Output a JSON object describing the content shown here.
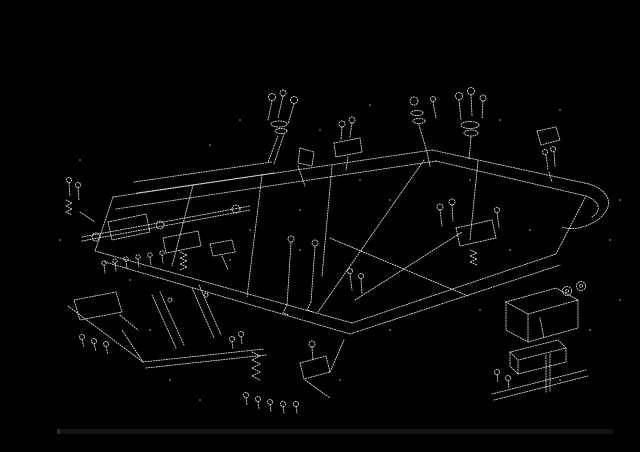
{
  "canvas": {
    "width": 640,
    "height": 452,
    "background": "#000000"
  },
  "diagram": {
    "description": "exploded-parts-diagram",
    "stroke_color": "#ededed",
    "stroke_width": 0.9,
    "stroke_dash": "1.2 1.4",
    "stroke_opacity": 0.92,
    "dot_color": "#d8d8d8",
    "elements": [
      {
        "t": "p",
        "d": "M113,197 L432,150"
      },
      {
        "t": "p",
        "d": "M116,209 L436,161"
      },
      {
        "t": "p",
        "d": "M134,182 L272,162"
      },
      {
        "t": "p",
        "d": "M137,193 L274,173"
      },
      {
        "t": "p",
        "d": "M432,150 L589,184"
      },
      {
        "t": "p",
        "d": "M436,161 L586,196"
      },
      {
        "t": "p",
        "d": "M589,184 C611,191 614,206 600,218 C589,227 573,231 562,227"
      },
      {
        "t": "p",
        "d": "M586,196 C600,201 602,211 592,217"
      },
      {
        "t": "p",
        "d": "M113,197 L95,251"
      },
      {
        "t": "p",
        "d": "M95,251 L352,323"
      },
      {
        "t": "p",
        "d": "M105,262 L350,334"
      },
      {
        "t": "p",
        "d": "M352,323 L556,254"
      },
      {
        "t": "p",
        "d": "M350,334 L560,265"
      },
      {
        "t": "p",
        "d": "M556,254 L586,196"
      },
      {
        "t": "p",
        "d": "M193,185 L172,266"
      },
      {
        "t": "p",
        "d": "M262,175 L247,297"
      },
      {
        "t": "p",
        "d": "M332,166 L322,276"
      },
      {
        "t": "p",
        "d": "M478,161 L470,240"
      },
      {
        "t": "p",
        "d": "M330,238 L468,296"
      },
      {
        "t": "p",
        "d": "M355,300 L462,232"
      },
      {
        "t": "p",
        "d": "M424,160 L318,312"
      },
      {
        "t": "p",
        "d": "M143,362 L264,349"
      },
      {
        "t": "p",
        "d": "M146,368 L266,355"
      },
      {
        "t": "p",
        "d": "M143,362 L122,330"
      },
      {
        "t": "p",
        "d": "M68,306 L143,362"
      },
      {
        "t": "c",
        "cx": 272,
        "cy": 97,
        "r": 3.5
      },
      {
        "t": "c",
        "cx": 283,
        "cy": 93,
        "r": 3
      },
      {
        "t": "c",
        "cx": 294,
        "cy": 100,
        "r": 3.5
      },
      {
        "t": "p",
        "d": "M272,101 L268,120 M283,96 L278,118 M294,104 L288,124"
      },
      {
        "t": "e",
        "cx": 279,
        "cy": 124,
        "rx": 8,
        "ry": 3
      },
      {
        "t": "e",
        "cx": 281,
        "cy": 131,
        "rx": 6,
        "ry": 2.5
      },
      {
        "t": "p",
        "d": "M278,136 L268,162 M284,134 L274,164"
      },
      {
        "t": "p",
        "d": "M300,148 L314,152 L312,166 L298,163 Z"
      },
      {
        "t": "p",
        "d": "M298,166 L305,186"
      },
      {
        "t": "c",
        "cx": 342,
        "cy": 124,
        "r": 3
      },
      {
        "t": "c",
        "cx": 352,
        "cy": 120,
        "r": 3
      },
      {
        "t": "p",
        "d": "M342,127 L341,140 M352,123 L350,137"
      },
      {
        "t": "p",
        "d": "M334,143 L360,138 L362,152 L336,157 Z"
      },
      {
        "t": "p",
        "d": "M348,157 L346,170"
      },
      {
        "t": "c",
        "cx": 414,
        "cy": 101,
        "r": 4
      },
      {
        "t": "e",
        "cx": 417,
        "cy": 113,
        "rx": 6,
        "ry": 2.5
      },
      {
        "t": "e",
        "cx": 419,
        "cy": 121,
        "rx": 6,
        "ry": 2.5
      },
      {
        "t": "p",
        "d": "M419,125 L427,152 L430,166"
      },
      {
        "t": "c",
        "cx": 433,
        "cy": 99,
        "r": 2.5
      },
      {
        "t": "p",
        "d": "M433,102 L436,118"
      },
      {
        "t": "c",
        "cx": 459,
        "cy": 96,
        "r": 3.5
      },
      {
        "t": "c",
        "cx": 471,
        "cy": 91,
        "r": 3.5
      },
      {
        "t": "c",
        "cx": 483,
        "cy": 98,
        "r": 3
      },
      {
        "t": "p",
        "d": "M459,100 L461,120 M471,95 L472,116 M483,101 L482,119"
      },
      {
        "t": "e",
        "cx": 470,
        "cy": 125,
        "rx": 9,
        "ry": 3.5
      },
      {
        "t": "e",
        "cx": 471,
        "cy": 133,
        "rx": 7,
        "ry": 3
      },
      {
        "t": "p",
        "d": "M471,137 L469,160"
      },
      {
        "t": "p",
        "d": "M537,131 L556,127 L560,140 L541,145 Z"
      },
      {
        "t": "c",
        "cx": 545,
        "cy": 152,
        "r": 2.5
      },
      {
        "t": "c",
        "cx": 553,
        "cy": 149,
        "r": 2.5
      },
      {
        "t": "p",
        "d": "M546,155 L548,170 M554,152 L555,166 M549,172 L552,182"
      },
      {
        "t": "c",
        "cx": 69,
        "cy": 180,
        "r": 2.5
      },
      {
        "t": "c",
        "cx": 78,
        "cy": 185,
        "r": 2.5
      },
      {
        "t": "p",
        "d": "M69,183 L70,196 M78,188 L79,200"
      },
      {
        "t": "p",
        "d": "M66,200 l6,3 l-6,3 l6,3 l-6,3 l6,3"
      },
      {
        "t": "p",
        "d": "M80,212 L95,222"
      },
      {
        "t": "p",
        "d": "M82,237 L250,206"
      },
      {
        "t": "p",
        "d": "M82,241 L250,210"
      },
      {
        "t": "c",
        "cx": 96,
        "cy": 237,
        "r": 4
      },
      {
        "t": "c",
        "cx": 160,
        "cy": 225,
        "r": 4
      },
      {
        "t": "c",
        "cx": 236,
        "cy": 209,
        "r": 4
      },
      {
        "t": "p",
        "d": "M108,222 L146,214 L150,232 L112,240 Z"
      },
      {
        "t": "p",
        "d": "M163,238 L198,231 L201,246 L166,253 Z"
      },
      {
        "t": "c",
        "cx": 104,
        "cy": 263,
        "r": 2.2
      },
      {
        "t": "c",
        "cx": 115,
        "cy": 261,
        "r": 2.2
      },
      {
        "t": "c",
        "cx": 126,
        "cy": 259,
        "r": 2.2
      },
      {
        "t": "c",
        "cx": 138,
        "cy": 257,
        "r": 2.2
      },
      {
        "t": "c",
        "cx": 150,
        "cy": 255,
        "r": 2.2
      },
      {
        "t": "c",
        "cx": 162,
        "cy": 253,
        "r": 2.2
      },
      {
        "t": "p",
        "d": "M104,265 l1,8 M115,263 l1,8 M126,261 l1,8 M138,259 l1,8 M150,257 l1,8 M162,255 l1,8"
      },
      {
        "t": "p",
        "d": "M180,252 l7,3 l-7,3 l7,3 l-7,3 l7,3 l-7,3"
      },
      {
        "t": "p",
        "d": "M210,244 L232,240 L235,252 L213,256 Z"
      },
      {
        "t": "p",
        "d": "M222,256 L228,270"
      },
      {
        "t": "p",
        "d": "M74,300 L116,292 L122,312 L80,320 Z"
      },
      {
        "t": "c",
        "cx": 82,
        "cy": 337,
        "r": 2.5
      },
      {
        "t": "c",
        "cx": 94,
        "cy": 341,
        "r": 2.5
      },
      {
        "t": "c",
        "cx": 106,
        "cy": 344,
        "r": 2.5
      },
      {
        "t": "p",
        "d": "M82,340 l2,7 M94,344 l2,7 M106,347 l2,7"
      },
      {
        "t": "p",
        "d": "M120,315 L138,330"
      },
      {
        "t": "p",
        "d": "M152,295 L176,348"
      },
      {
        "t": "p",
        "d": "M160,292 L184,345"
      },
      {
        "t": "p",
        "d": "M192,288 L214,338"
      },
      {
        "t": "p",
        "d": "M199,285 L221,335"
      },
      {
        "t": "c",
        "cx": 170,
        "cy": 300,
        "r": 2
      },
      {
        "t": "c",
        "cx": 206,
        "cy": 295,
        "r": 2
      },
      {
        "t": "p",
        "d": "M252,352 l8,4 l-8,4 l8,4 l-8,4 l8,4 l-8,4 l8,4"
      },
      {
        "t": "c",
        "cx": 246,
        "cy": 395,
        "r": 2.5
      },
      {
        "t": "c",
        "cx": 258,
        "cy": 399,
        "r": 2.5
      },
      {
        "t": "c",
        "cx": 270,
        "cy": 402,
        "r": 2.5
      },
      {
        "t": "c",
        "cx": 283,
        "cy": 404,
        "r": 2.5
      },
      {
        "t": "c",
        "cx": 296,
        "cy": 404,
        "r": 2.5
      },
      {
        "t": "p",
        "d": "M246,398 l1,7 M258,402 l1,7 M270,405 l1,6 M283,407 l1,6 M296,407 l1,6"
      },
      {
        "t": "p",
        "d": "M300,363 L326,356 L330,372 L304,379 Z"
      },
      {
        "t": "c",
        "cx": 312,
        "cy": 344,
        "r": 3
      },
      {
        "t": "p",
        "d": "M312,347 L313,360"
      },
      {
        "t": "p",
        "d": "M305,380 L330,398 M330,372 L344,340"
      },
      {
        "t": "c",
        "cx": 232,
        "cy": 339,
        "r": 2.5
      },
      {
        "t": "c",
        "cx": 241,
        "cy": 334,
        "r": 2.5
      },
      {
        "t": "p",
        "d": "M232,342 l1,7 M241,337 l1,7"
      },
      {
        "t": "p",
        "d": "M291,243 L287,305"
      },
      {
        "t": "p",
        "d": "M315,247 L311,302"
      },
      {
        "t": "c",
        "cx": 291,
        "cy": 239,
        "r": 3
      },
      {
        "t": "c",
        "cx": 315,
        "cy": 243,
        "r": 3
      },
      {
        "t": "p",
        "d": "M287,305 l-4,8 l6,2 M311,302 l-4,8 l6,2"
      },
      {
        "t": "c",
        "cx": 350,
        "cy": 271,
        "r": 2.5
      },
      {
        "t": "c",
        "cx": 361,
        "cy": 276,
        "r": 2.5
      },
      {
        "t": "p",
        "d": "M350,274 L352,290 M361,279 L362,294"
      },
      {
        "t": "c",
        "cx": 440,
        "cy": 207,
        "r": 3
      },
      {
        "t": "c",
        "cx": 452,
        "cy": 202,
        "r": 3
      },
      {
        "t": "p",
        "d": "M440,210 L442,226 M452,205 L453,221"
      },
      {
        "t": "p",
        "d": "M456,228 L492,220 L496,238 L460,246 Z"
      },
      {
        "t": "p",
        "d": "M470,250 l7,3 l-7,3 l7,3 l-7,3 l7,3"
      },
      {
        "t": "c",
        "cx": 497,
        "cy": 210,
        "r": 2.5
      },
      {
        "t": "p",
        "d": "M497,213 L499,227"
      },
      {
        "t": "p",
        "d": "M506,302 L556,288 L578,300 L528,314 Z"
      },
      {
        "t": "p",
        "d": "M506,302 L506,330 L528,342 L528,314"
      },
      {
        "t": "p",
        "d": "M528,342 L578,328 L578,300"
      },
      {
        "t": "c",
        "cx": 567,
        "cy": 291,
        "r": 4.5
      },
      {
        "t": "c",
        "cx": 567,
        "cy": 291,
        "r": 1.5
      },
      {
        "t": "c",
        "cx": 581,
        "cy": 286,
        "r": 4.5
      },
      {
        "t": "c",
        "cx": 581,
        "cy": 286,
        "r": 1.5
      },
      {
        "t": "p",
        "d": "M510,352 L558,340 L566,348 L518,360 Z"
      },
      {
        "t": "p",
        "d": "M510,352 L510,366 L518,374 L518,360"
      },
      {
        "t": "p",
        "d": "M518,374 L566,362 L566,348"
      },
      {
        "t": "c",
        "cx": 497,
        "cy": 372,
        "r": 2.5
      },
      {
        "t": "c",
        "cx": 508,
        "cy": 378,
        "r": 2.5
      },
      {
        "t": "p",
        "d": "M497,375 l1,7 M508,381 l1,7"
      },
      {
        "t": "p",
        "d": "M492,394 L586,370 M494,400 L588,376"
      },
      {
        "t": "p",
        "d": "M540,318 L544,338"
      },
      {
        "t": "p",
        "d": "M546,355 L546,392 M550,354 L550,391"
      }
    ],
    "dots": [
      [
        210,
        145
      ],
      [
        320,
        130
      ],
      [
        370,
        105
      ],
      [
        500,
        120
      ],
      [
        560,
        110
      ],
      [
        620,
        200
      ],
      [
        610,
        240
      ],
      [
        80,
        160
      ],
      [
        60,
        240
      ],
      [
        250,
        230
      ],
      [
        300,
        210
      ],
      [
        390,
        200
      ],
      [
        420,
        300
      ],
      [
        480,
        310
      ],
      [
        390,
        330
      ],
      [
        170,
        380
      ],
      [
        200,
        400
      ],
      [
        340,
        380
      ],
      [
        560,
        380
      ],
      [
        590,
        330
      ],
      [
        130,
        280
      ],
      [
        230,
        260
      ],
      [
        510,
        250
      ],
      [
        530,
        230
      ],
      [
        470,
        180
      ],
      [
        360,
        180
      ],
      [
        240,
        120
      ],
      [
        300,
        250
      ],
      [
        150,
        330
      ],
      [
        620,
        300
      ]
    ]
  },
  "bottom_bar": {
    "x": 57,
    "y": 429,
    "width": 556,
    "height": 5,
    "color": "#131313",
    "left_cap_color": "#2b2b2b",
    "left_cap_width": 3
  }
}
